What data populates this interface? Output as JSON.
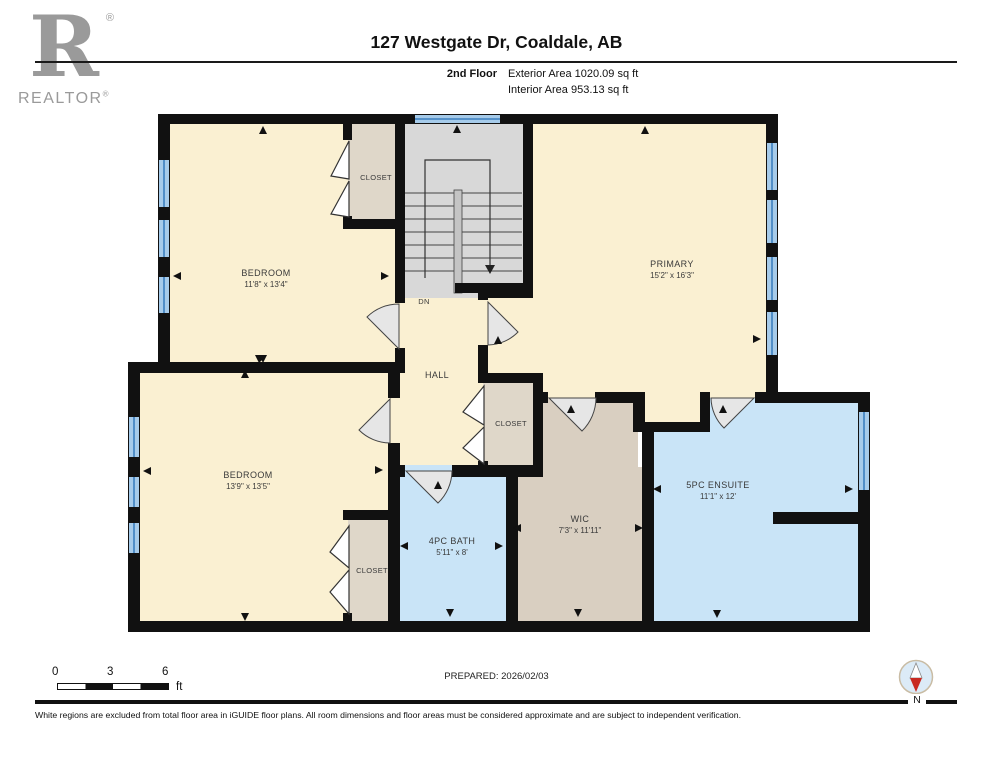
{
  "logo": {
    "letter": "R",
    "brand": "REALTOR",
    "registered": "®"
  },
  "header": {
    "title": "127 Westgate Dr, Coaldale, AB",
    "floor_label": "2nd Floor",
    "exterior_area": "Exterior Area 1020.09 sq ft",
    "interior_area": "Interior Area 953.13 sq ft"
  },
  "rooms": {
    "bedroom_top": {
      "name": "BEDROOM",
      "dims": "11'8\" x 13'4\""
    },
    "bedroom_bottom": {
      "name": "BEDROOM",
      "dims": "13'9\" x 13'5\""
    },
    "primary": {
      "name": "PRIMARY",
      "dims": "15'2\" x 16'3\""
    },
    "bath": {
      "name": "4PC BATH",
      "dims": "5'11\" x 8'"
    },
    "wic": {
      "name": "WIC",
      "dims": "7'3\" x 11'11\""
    },
    "ensuite": {
      "name": "5PC ENSUITE",
      "dims": "11'1\" x 12'"
    },
    "hall": {
      "name": "HALL"
    },
    "closet": {
      "name": "CLOSET"
    },
    "stairs": {
      "down": "DN"
    }
  },
  "footer": {
    "scale": {
      "ticks": [
        "0",
        "3",
        "6"
      ],
      "unit": "ft"
    },
    "prepared": "PREPARED: 2026/02/03",
    "compass_label": "N",
    "disclaimer": "White regions are excluded from total floor area in iGUIDE floor plans. All room dimensions and floor areas must be considered approximate and are subject to independent verification."
  },
  "colors": {
    "wall": "#111111",
    "room_cream": "#FAF0D2",
    "closet_tan": "#DFD7C9",
    "wic_tan": "#D9CFC1",
    "bath_blue": "#C9E4F7",
    "stairs_gray": "#D8D8D8",
    "window_blue": "#A6CBEA",
    "window_line": "#3B7FBF",
    "logo_gray": "#9A9A9A",
    "compass_red": "#C82A21"
  }
}
